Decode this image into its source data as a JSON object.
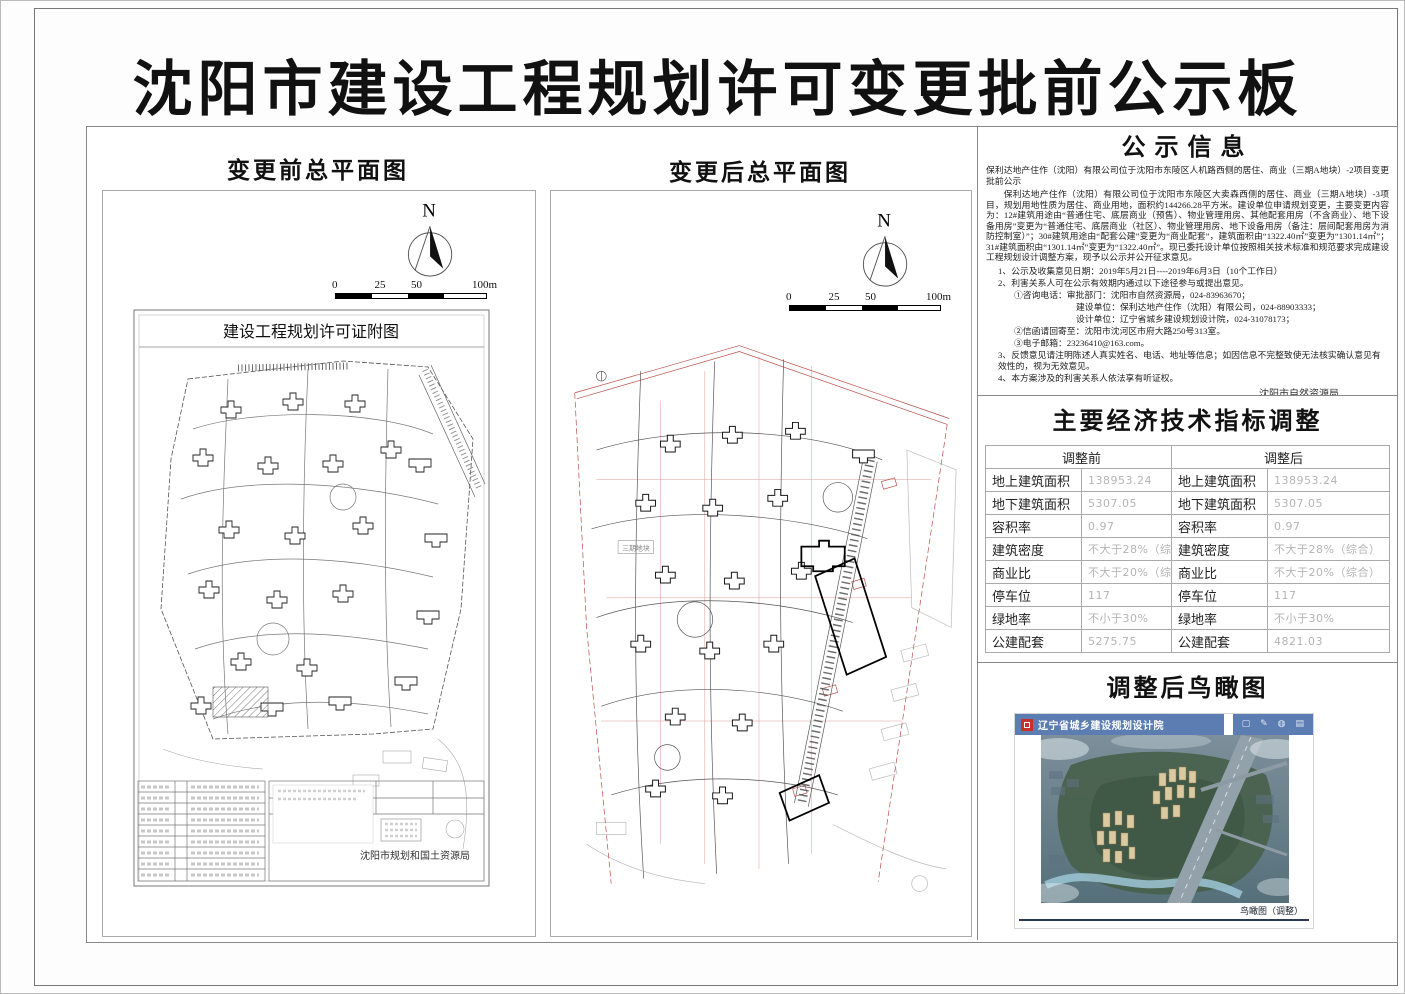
{
  "page_title": "沈阳市建设工程规划许可变更批前公示板",
  "colors": {
    "cad_red": "#b23a33",
    "viewer_header_blue": "#5b7db1",
    "logo_red": "#c9302c",
    "faint_value_gray": "#b4b4b4"
  },
  "plan_before": {
    "heading": "变更前总平面图",
    "north_label": "N",
    "scale_labels": [
      "0",
      "25",
      "50",
      "100m"
    ],
    "drawing_title": "建设工程规划许可证附图",
    "agency_stamp": "沈阳市规划和国土资源局"
  },
  "plan_after": {
    "heading": "变更后总平面图",
    "north_label": "N",
    "scale_labels": [
      "0",
      "25",
      "50",
      "100m"
    ],
    "parcel_label": "三期地块"
  },
  "notice": {
    "title": "公示信息",
    "intro": "保利达地产住作（沈阳）有限公司位于沈阳市东陵区人机路西侧的居住、商业（三期A地块）-2项目变更批前公示",
    "body": "保利达地产住作（沈阳）有限公司位于沈阳市东陵区大卖森西侧的居住、商业（三期A地块）-3项目，规划用地性质为居住、商业用地，面积约144266.28平方米。建设单位申请规划变更，主要变更内容为：12#建筑用途由“普通住宅、底层商业（预售）、物业管理用房、其他配套用房（不含商业）、地下设备用房”变更为“普通住宅、底层商业（社区）、物业管理用房、地下设备用房（备注：层间配套用房为消防控制室）”；30#建筑用途由“配套公建”变更为“商业配套”，建筑面积由“1322.40㎡”变更为“1301.14㎡”；31#建筑面积由“1301.14㎡”变更为“1322.40㎡”。现已委托设计单位按照相关技术标准和规范要求完成建设工程规划设计调整方案，现予以公示并公开征求意见。",
    "items": [
      "1、公示及收集意见日期：2019年5月21日----2019年6月3日（10个工作日）",
      "2、利害关系人可在公示有效期内通过以下途径参与或提出意见。",
      "①咨询电话：审批部门：沈阳市自然资源局，024-83963670；",
      "建设单位：保利达地产住作（沈阳）有限公司，024-88903333；",
      "设计单位：辽宁省城乡建设规划设计院，024-31078173；",
      "②信函请回寄至：沈阳市沈河区市府大路250号313室。",
      "③电子邮箱：23236410@163.com。",
      "3、反馈意见请注明陈述人真实姓名、电话、地址等信息；如因信息不完整致使无法核实确认意见有效性的，视为无效意见。",
      "4、本方案涉及的利害关系人依法享有听证权。"
    ],
    "sign_agency": "沈阳市自然资源局",
    "sign_date": "2019年5月21日"
  },
  "indicators": {
    "title": "主要经济技术指标调整",
    "header_before": "调整前",
    "header_after": "调整后",
    "rows": [
      {
        "label": "地上建筑面积",
        "before": "138953.24",
        "after": "138953.24"
      },
      {
        "label": "地下建筑面积",
        "before": "5307.05",
        "after": "5307.05"
      },
      {
        "label": "容积率",
        "before": "0.97",
        "after": "0.97"
      },
      {
        "label": "建筑密度",
        "before": "不大于28%（综合）",
        "after": "不大于28%（综合）"
      },
      {
        "label": "商业比",
        "before": "不大于20%（综合）",
        "after": "不大于20%（综合）"
      },
      {
        "label": "停车位",
        "before": "117",
        "after": "117"
      },
      {
        "label": "绿地率",
        "before": "不小于30%",
        "after": "不小于30%"
      },
      {
        "label": "公建配套",
        "before": "5275.75",
        "after": "4821.03"
      }
    ]
  },
  "birdseye": {
    "title": "调整后鸟瞰图",
    "viewer_title": "辽宁省城乡建设规划设计院",
    "toolbar_icons": [
      "▢",
      "✎",
      "◍",
      "▤"
    ],
    "caption": "鸟瞰图（调整）"
  }
}
